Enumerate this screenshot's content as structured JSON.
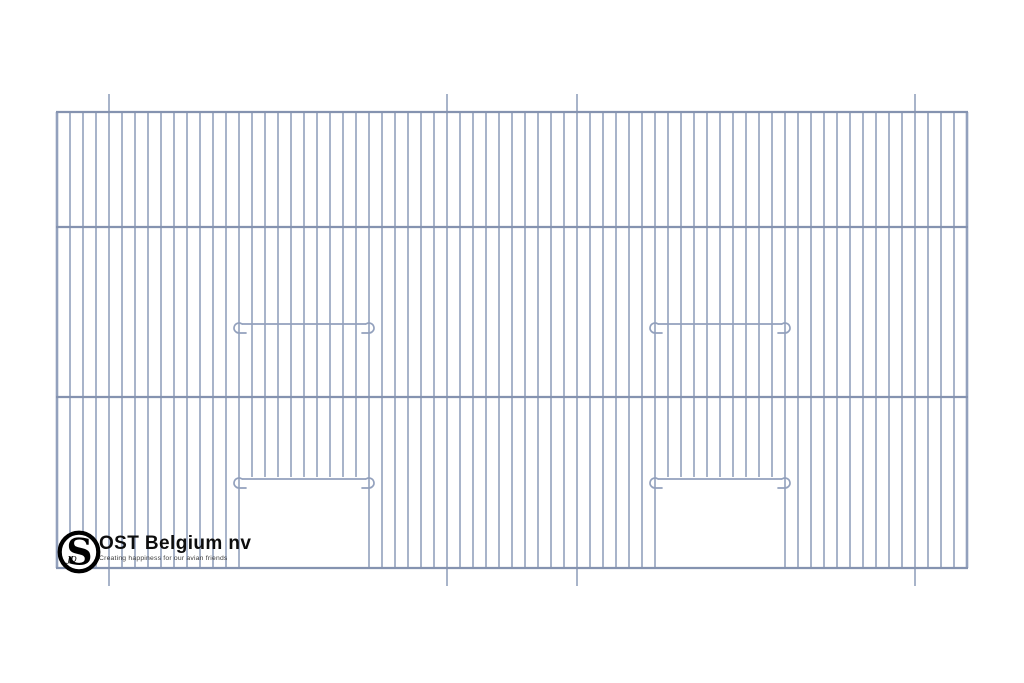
{
  "brand": {
    "name": "OST Belgium nv",
    "tagline": "Creating happiness for our avian friends",
    "monogram": "S",
    "monogram_sub": "JD",
    "logo_ring_color": "#000000",
    "name_color": "#0d0d0d",
    "tagline_color": "#3c3c3c"
  },
  "panel": {
    "canvas_width": 1024,
    "canvas_height": 683,
    "left": 57,
    "right": 967,
    "top": 112,
    "bottom": 568,
    "rail_ys": [
      112,
      227,
      397,
      568
    ],
    "bar_count": 71,
    "bar_spacing": 13,
    "bar_width": 1.6,
    "edge_bar_width": 2.6,
    "rail_width": 2.2,
    "hook_wire_width": 1.7,
    "wire_color": "#93a1bd",
    "rail_color": "#8593b0",
    "extension_bar_indices": [
      4,
      30,
      40,
      66
    ],
    "extension_length": 18,
    "doors": [
      {
        "left_bar": 14,
        "right_bar": 24,
        "perch_wire_y": 324,
        "door_wire_y": 479
      },
      {
        "left_bar": 46,
        "right_bar": 56,
        "perch_wire_y": 324,
        "door_wire_y": 479
      }
    ]
  }
}
